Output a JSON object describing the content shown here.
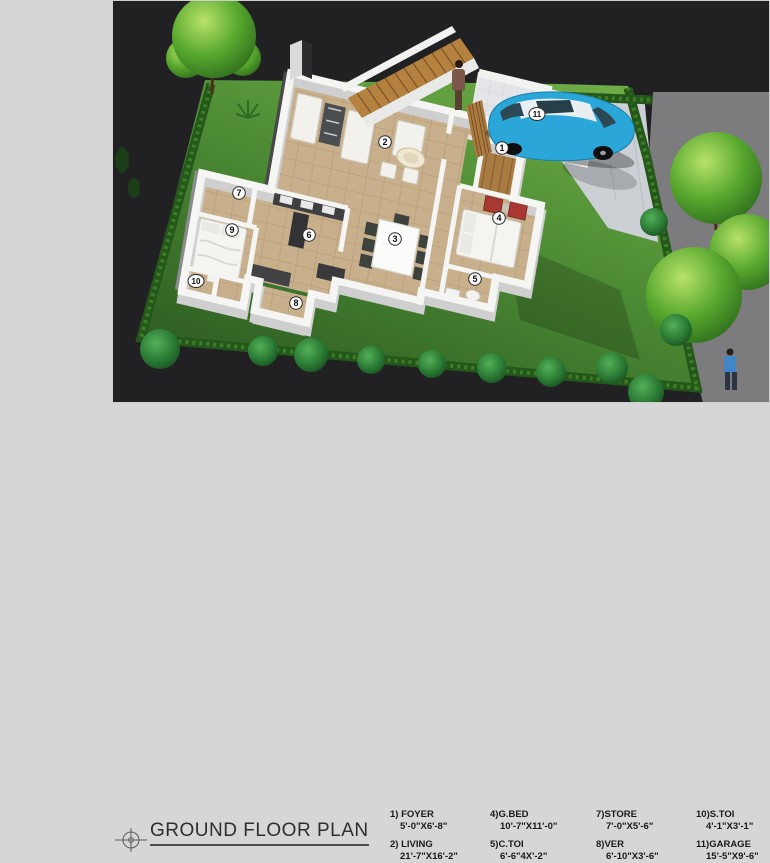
{
  "caption": {
    "title": "GROUND FLOOR PLAN"
  },
  "legend": {
    "items": [
      {
        "label": "1) FOYER",
        "size": "5'-0\"X6'-8\""
      },
      {
        "label": "2) LIVING",
        "size": "21'-7\"X16'-2\""
      },
      {
        "label": "4)G.BED",
        "size": "10'-7\"X11'-0\""
      },
      {
        "label": "5)C.TOI",
        "size": "6'-6\"4X'-2\""
      },
      {
        "label": "7)STORE",
        "size": "7'-0\"X5'-6\""
      },
      {
        "label": "8)VER",
        "size": "6'-10\"X3'-6\""
      },
      {
        "label": "10)S.TOI",
        "size": "4'-1\"X3'-1\""
      },
      {
        "label": "11)GARAGE",
        "size": "15'-5\"X9'-6\""
      }
    ]
  },
  "render": {
    "labels": [
      "1",
      "2",
      "3",
      "4",
      "5",
      "6",
      "7",
      "8",
      "9",
      "10",
      "11"
    ],
    "colors": {
      "page_bg": "#d6d6d6",
      "scene_bg": "#212124",
      "road": "#7c7c7e",
      "grass": "#498632",
      "hedge": "#24571a",
      "floor_tile": "#c8b08c",
      "wall": "#f5f5f3",
      "wood": "#a87b42",
      "car": "#2aa7d8",
      "chair_red": "#a83832"
    }
  }
}
